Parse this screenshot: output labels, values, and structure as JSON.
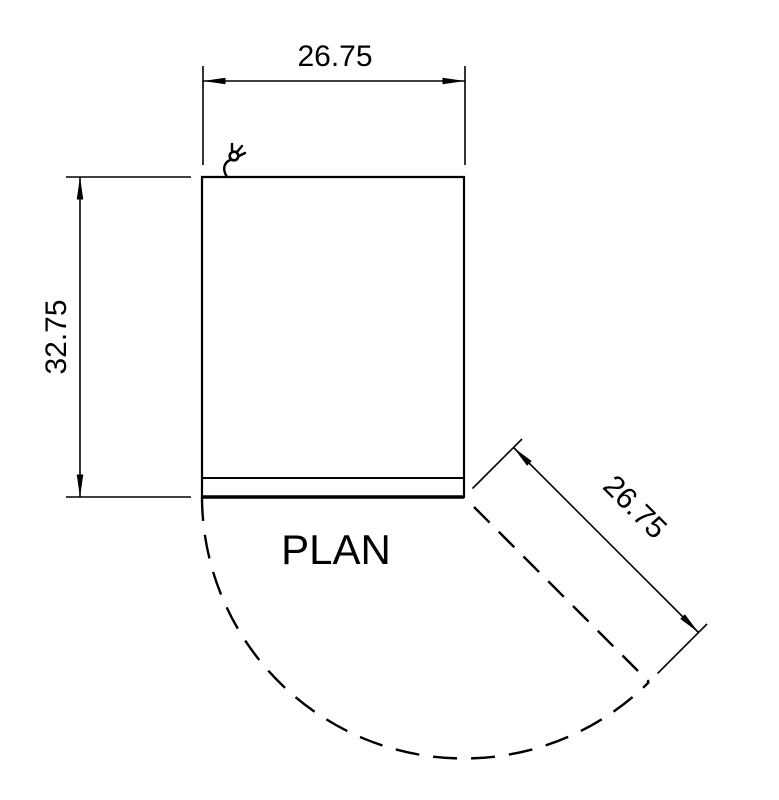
{
  "drawing": {
    "view_label": "PLAN",
    "width_dim": "26.75",
    "depth_dim": "32.75",
    "door_swing_dim": "26.75",
    "colors": {
      "line": "#000000",
      "background": "#ffffff"
    },
    "icons": {
      "power_cord": "power-cord-plug"
    }
  }
}
